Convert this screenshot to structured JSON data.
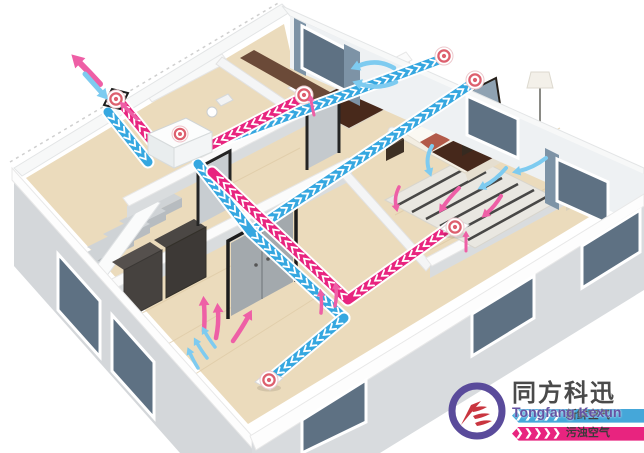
{
  "brand": {
    "name_cn": "同方科迅",
    "name_en": "Tongfang Kexun",
    "fresh_air_label": "新鲜空气",
    "polluted_air_label": "污浊空气",
    "fresh_chevrons": "❯❯❯❯❯",
    "polluted_chevrons": "❯❯❯❯❯"
  },
  "colors": {
    "fresh_air": "#35a7e0",
    "exhaust_air": "#e8247f",
    "fresh_arrow": "#7ecbf0",
    "exhaust_arrow": "#ee5fa6",
    "vent_ring": "#dd5f6e",
    "logo_purple": "#5a4b9b",
    "logo_red": "#c9353f",
    "banner_blue": "#45a7d9",
    "banner_pink": "#e8247f"
  },
  "unit": {
    "name": "erv-ventilation-unit",
    "x": 148,
    "y": 118
  },
  "ducts": [
    {
      "name": "fresh-intake-duct",
      "type": "fresh",
      "points": [
        [
          108,
          112
        ],
        [
          148,
          162
        ]
      ]
    },
    {
      "name": "fresh-supply-bedroom1",
      "type": "fresh",
      "points": [
        [
          196,
          150
        ],
        [
          444,
          58
        ]
      ]
    },
    {
      "name": "fresh-supply-bedroom2",
      "type": "fresh",
      "points": [
        [
          251,
          232
        ],
        [
          474,
          82
        ]
      ]
    },
    {
      "name": "fresh-supply-trunk",
      "type": "fresh",
      "points": [
        [
          198,
          164
        ],
        [
          251,
          232
        ],
        [
          344,
          318
        ]
      ]
    },
    {
      "name": "fresh-supply-living",
      "type": "fresh",
      "points": [
        [
          344,
          318
        ],
        [
          272,
          378
        ]
      ]
    },
    {
      "name": "exhaust-outlet-duct",
      "type": "exhaust",
      "points": [
        [
          156,
          146
        ],
        [
          122,
          104
        ]
      ]
    },
    {
      "name": "exhaust-bath-duct",
      "type": "exhaust",
      "points": [
        [
          298,
          100
        ],
        [
          206,
          148
        ]
      ]
    },
    {
      "name": "exhaust-bedroom2-duct",
      "type": "exhaust",
      "points": [
        [
          452,
          226
        ],
        [
          348,
          300
        ],
        [
          212,
          172
        ]
      ]
    }
  ],
  "vents": [
    {
      "name": "exterior-wall-vent",
      "x": 116,
      "y": 99,
      "style": "wall"
    },
    {
      "name": "bath-extract-vent",
      "x": 304,
      "y": 95,
      "style": "round"
    },
    {
      "name": "bedroom1-supply-vent",
      "x": 444,
      "y": 56,
      "style": "round"
    },
    {
      "name": "bedroom2-supply-vent",
      "x": 475,
      "y": 80,
      "style": "round"
    },
    {
      "name": "bedroom2-extract-vent",
      "x": 455,
      "y": 227,
      "style": "floor"
    },
    {
      "name": "living-supply-vent",
      "x": 269,
      "y": 380,
      "style": "floor"
    }
  ],
  "arrows": [
    {
      "name": "exhaust-out-arrow",
      "color": "exhaust",
      "w": 6,
      "pts": [
        100,
        84,
        90,
        73,
        79,
        62
      ]
    },
    {
      "name": "fresh-in-arrow",
      "color": "fresh",
      "w": 5,
      "pts": [
        85,
        74,
        93,
        83,
        102,
        93
      ]
    },
    {
      "name": "exhaust-small-arrow",
      "color": "exhaust",
      "w": 3.5,
      "pts": [
        137,
        119,
        130,
        112,
        124,
        106
      ]
    },
    {
      "name": "bedroom1-fresh-arrow-a",
      "color": "fresh",
      "w": 4.5,
      "pts": [
        394,
        68,
        377,
        58,
        358,
        66
      ]
    },
    {
      "name": "bedroom1-fresh-arrow-b",
      "color": "fresh",
      "w": 4.5,
      "pts": [
        396,
        82,
        379,
        90,
        360,
        84
      ]
    },
    {
      "name": "bath-exhaust-tick",
      "color": "exhaust",
      "w": 3,
      "pts": [
        314,
        115,
        312,
        107,
        311,
        100
      ]
    },
    {
      "name": "bedroom2-fresh-arrow-a",
      "color": "fresh",
      "w": 4,
      "pts": [
        432,
        146,
        425,
        158,
        429,
        170
      ]
    },
    {
      "name": "bedroom2-fresh-arrow-b",
      "color": "fresh",
      "w": 4,
      "pts": [
        506,
        168,
        496,
        180,
        484,
        186
      ]
    },
    {
      "name": "bedroom2-fresh-arrow-c",
      "color": "fresh",
      "w": 4,
      "pts": [
        546,
        158,
        533,
        168,
        519,
        171
      ]
    },
    {
      "name": "bedroom2-exhaust-arrow-a",
      "color": "exhaust",
      "w": 4,
      "pts": [
        459,
        188,
        449,
        198,
        443,
        207
      ]
    },
    {
      "name": "bedroom2-exhaust-arrow-b",
      "color": "exhaust",
      "w": 4,
      "pts": [
        501,
        196,
        495,
        206,
        487,
        213
      ]
    },
    {
      "name": "bedroom2-exhaust-arrow-c",
      "color": "exhaust",
      "w": 3.5,
      "pts": [
        399,
        187,
        394,
        197,
        396,
        206
      ]
    },
    {
      "name": "bedroom2-exhaust-tick",
      "color": "exhaust",
      "w": 3,
      "pts": [
        466,
        251,
        466,
        243,
        466,
        236
      ]
    },
    {
      "name": "living-exhaust-arrow-a",
      "color": "exhaust",
      "w": 4.5,
      "pts": [
        204,
        331,
        205,
        317,
        204,
        304
      ]
    },
    {
      "name": "living-exhaust-arrow-b",
      "color": "exhaust",
      "w": 4.5,
      "pts": [
        216,
        338,
        219,
        324,
        218,
        311
      ]
    },
    {
      "name": "living-exhaust-arrow-c",
      "color": "exhaust",
      "w": 4.5,
      "pts": [
        233,
        341,
        242,
        328,
        248,
        317
      ]
    },
    {
      "name": "living-fresh-arrow-a",
      "color": "fresh",
      "w": 3.5,
      "pts": [
        215,
        347,
        209,
        339,
        205,
        332
      ]
    },
    {
      "name": "living-fresh-arrow-b",
      "color": "fresh",
      "w": 3.5,
      "pts": [
        207,
        358,
        201,
        350,
        197,
        343
      ]
    },
    {
      "name": "living-fresh-arrow-c",
      "color": "fresh",
      "w": 3.5,
      "pts": [
        198,
        368,
        193,
        360,
        190,
        353
      ]
    },
    {
      "name": "hall-exhaust-tick-a",
      "color": "exhaust",
      "w": 3.5,
      "pts": [
        321,
        313,
        322,
        304,
        321,
        295
      ]
    },
    {
      "name": "hall-exhaust-tick-b",
      "color": "exhaust",
      "w": 3.5,
      "pts": [
        335,
        306,
        337,
        297,
        336,
        288
      ]
    }
  ]
}
